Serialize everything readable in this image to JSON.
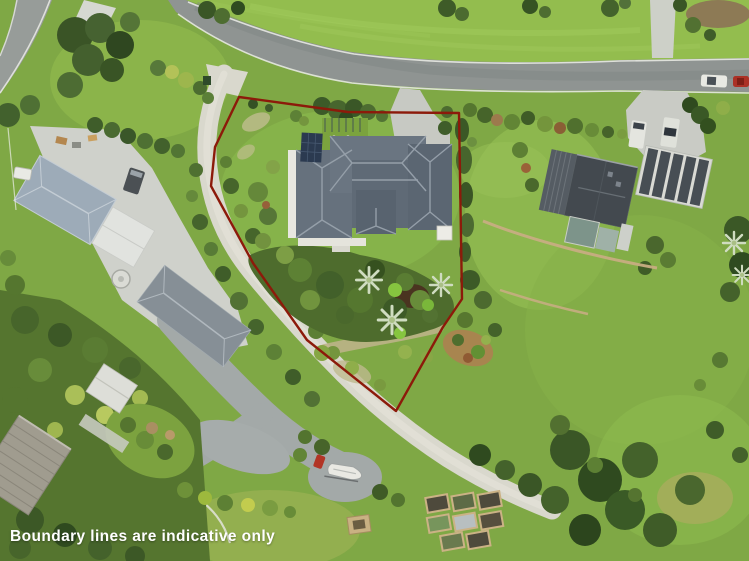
{
  "caption": {
    "text": "Boundary lines are indicative only",
    "color": "#ffffff"
  },
  "boundary": {
    "points": "239,97 348,112 459,113 462,299 443,327 396,411 307,340 253,263 211,186 215,147",
    "color": "#8c1a0a",
    "stroke_width": "2.4"
  }
}
